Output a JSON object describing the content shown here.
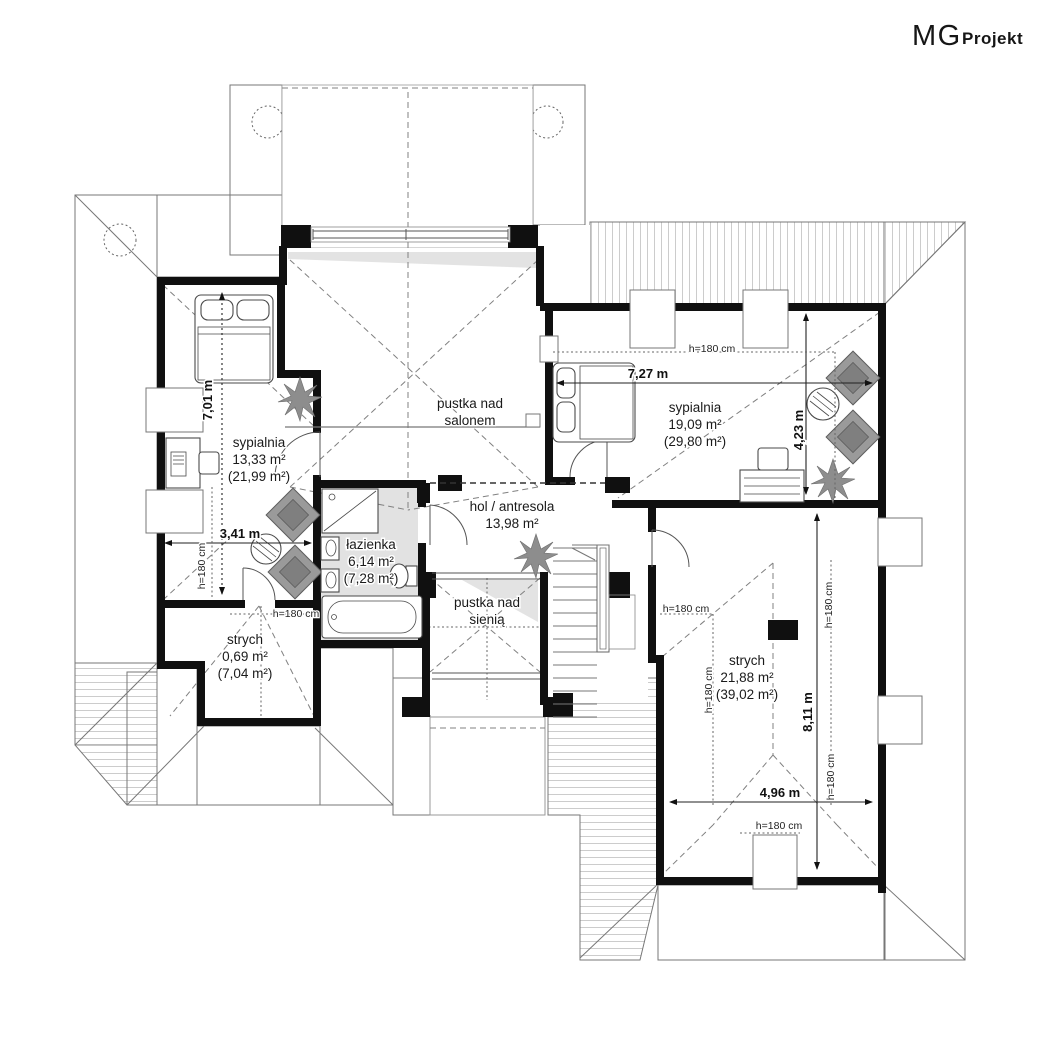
{
  "logo": {
    "mg": "MG",
    "projekt": "Projekt"
  },
  "rooms": {
    "sypialnia1": {
      "name": "sypialnia",
      "area": "13,33 m²",
      "area_total": "(21,99 m²)"
    },
    "sypialnia2": {
      "name": "sypialnia",
      "area": "19,09 m²",
      "area_total": "(29,80 m²)"
    },
    "lazienka": {
      "name": "łazienka",
      "area": "6,14 m²",
      "area_total": "(7,28 m²)"
    },
    "hol": {
      "name": "hol / antresola",
      "area": "13,98 m²"
    },
    "pustka_salon": {
      "line1": "pustka nad",
      "line2": "salonem"
    },
    "pustka_sien": {
      "line1": "pustka nad",
      "line2": "sienią"
    },
    "strych1": {
      "name": "strych",
      "area": "0,69 m²",
      "area_total": "(7,04 m²)"
    },
    "strych2": {
      "name": "strych",
      "area": "21,88 m²",
      "area_total": "(39,02 m²)"
    }
  },
  "dimensions": {
    "bedroom1_height": "7,01 m",
    "bedroom1_width": "3,41 m",
    "bedroom2_width": "7,27 m",
    "bedroom2_height": "4,23 m",
    "strych2_height": "8,11 m",
    "strych2_width": "4,96 m",
    "knee_wall": "h=180 cm"
  },
  "colors": {
    "wall": "#101010",
    "hatch": "#c6c6c6",
    "bath_floor": "#e2e2e2",
    "furniture_gray": "#9a9a9a"
  }
}
